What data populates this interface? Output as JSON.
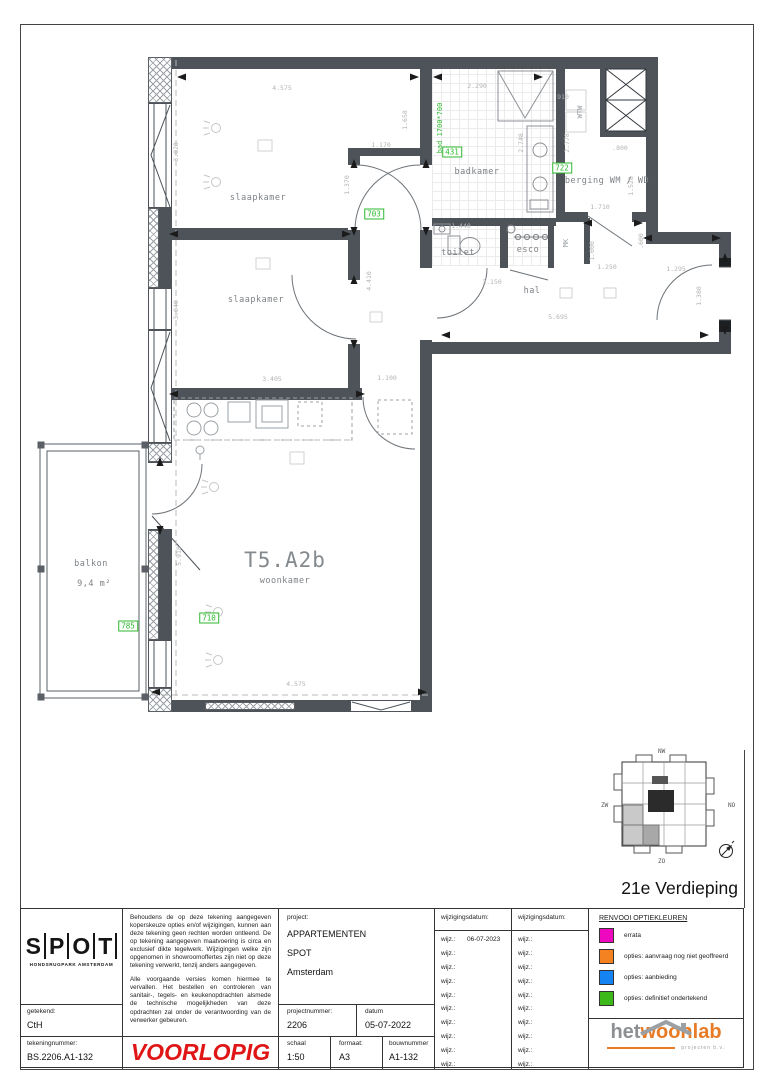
{
  "page": {
    "floor_title": "21e Verdieping"
  },
  "plan": {
    "unit_code": "T5.A2b",
    "unit_room": "woonkamer",
    "room_labels": [
      {
        "label": "slaapkamer",
        "x": 258,
        "y": 198
      },
      {
        "label": "slaapkamer",
        "x": 256,
        "y": 300
      },
      {
        "label": "badkamer",
        "x": 477,
        "y": 172
      },
      {
        "label": "berging WM / WD",
        "x": 607,
        "y": 181
      },
      {
        "label": "toilet",
        "x": 458,
        "y": 253
      },
      {
        "label": "esco",
        "x": 528,
        "y": 250
      },
      {
        "label": "hal",
        "x": 532,
        "y": 291
      },
      {
        "label": "balkon",
        "x": 91,
        "y": 564
      },
      {
        "label": "9,4  m²",
        "x": 94,
        "y": 584
      }
    ],
    "vertical_texts": [
      {
        "label": "bad 1700*700",
        "x": 440,
        "y": 128,
        "green": true
      },
      {
        "label": "WTW",
        "x": 580,
        "y": 112
      },
      {
        "label": "MK",
        "x": 566,
        "y": 243
      }
    ],
    "option_labels": [
      {
        "label": "431",
        "x": 452,
        "y": 152
      },
      {
        "label": "722",
        "x": 562,
        "y": 168
      },
      {
        "label": "703",
        "x": 374,
        "y": 214
      },
      {
        "label": "710",
        "x": 209,
        "y": 618
      },
      {
        "label": "785",
        "x": 128,
        "y": 626
      }
    ],
    "dimensions": [
      {
        "t": "4.575",
        "x": 282,
        "y": 88
      },
      {
        "t": "3.028",
        "x": 176,
        "y": 152,
        "r": 1
      },
      {
        "t": "1.170",
        "x": 381,
        "y": 145
      },
      {
        "t": "1.370",
        "x": 347,
        "y": 185,
        "r": 1
      },
      {
        "t": "1.658",
        "x": 405,
        "y": 120,
        "r": 1
      },
      {
        "t": "2.290",
        "x": 477,
        "y": 86
      },
      {
        "t": "2.748",
        "x": 521,
        "y": 143,
        "r": 1
      },
      {
        "t": "910",
        "x": 563,
        "y": 97
      },
      {
        "t": "2.778",
        "x": 567,
        "y": 143,
        "r": 1
      },
      {
        "t": ".800",
        "x": 620,
        "y": 148
      },
      {
        "t": "1.528",
        "x": 631,
        "y": 186,
        "r": 1
      },
      {
        "t": "1.710",
        "x": 600,
        "y": 207
      },
      {
        "t": "1.440",
        "x": 461,
        "y": 226
      },
      {
        "t": "3.150",
        "x": 492,
        "y": 282
      },
      {
        "t": "1.000",
        "x": 592,
        "y": 251,
        "r": 1
      },
      {
        "t": ".600",
        "x": 641,
        "y": 241,
        "r": 1
      },
      {
        "t": "1.250",
        "x": 607,
        "y": 267
      },
      {
        "t": "1.295",
        "x": 676,
        "y": 269
      },
      {
        "t": "1.380",
        "x": 699,
        "y": 296,
        "r": 1
      },
      {
        "t": "5.695",
        "x": 558,
        "y": 317
      },
      {
        "t": "3.405",
        "x": 272,
        "y": 379
      },
      {
        "t": "3.040",
        "x": 176,
        "y": 310,
        "r": 1
      },
      {
        "t": "4.410",
        "x": 369,
        "y": 281,
        "r": 1
      },
      {
        "t": "1.100",
        "x": 387,
        "y": 378
      },
      {
        "t": "4.575",
        "x": 296,
        "y": 684
      },
      {
        "t": "5.918",
        "x": 179,
        "y": 556,
        "r": 1
      }
    ]
  },
  "keyplan": {
    "north_west": "NW",
    "south_west": "ZW",
    "north_east": "NO",
    "south_east": "ZO"
  },
  "titleblock": {
    "logo_letters": [
      "S",
      "P",
      "O",
      "T"
    ],
    "logo_sub": "HONDSRUGPARK AMSTERDAM",
    "getekend_label": "getekend:",
    "getekend_value": "CtH",
    "tekeningnummer_label": "tekeningnummer:",
    "tekeningnummer_value": "BS.2206.A1-132",
    "disclaimer_p1": "Behoudens de op deze tekening aangegeven koperskeuze opties en/of wijzigingen, kunnen aan deze tekening geen rechten worden ontleend. De op tekening aangegeven maatvoering is circa en exclusief dikte tegelwerk. Wijzigingen welke zijn opgenomen in showroomoffertes zijn niet op deze tekening verwerkt, tenzij anders aangegeven.",
    "disclaimer_p2": "Alle voorgaande versies komen hiermee te vervallen. Het bestellen en controleren van sanitair-, tegels- en keukenopdrachten alsmede de technische mogelijkheden van deze opdrachten zal onder de verantwoording van de verwerker gebeuren.",
    "stamp": "VOORLOPIG",
    "project_label": "project:",
    "project_name": "APPARTEMENTEN",
    "project_sub": "SPOT",
    "project_city": "Amsterdam",
    "projectnummer_label": "projectnummer:",
    "projectnummer_value": "2206",
    "datum_label": "datum",
    "datum_value": "05-07-2022",
    "schaal_label": "schaal",
    "schaal_value": "1:50",
    "formaat_label": "formaat:",
    "formaat_value": "A3",
    "bouwnummer_label": "bouwnummer",
    "bouwnummer_value": "A1-132",
    "wijzigingsdatum_label": "wijzigingsdatum:",
    "wijz_label": "wijz.:",
    "wijz_col1": [
      "06-07-2023",
      "",
      "",
      "",
      "",
      "",
      "",
      "",
      "",
      ""
    ],
    "wijz_col2": [
      "",
      "",
      "",
      "",
      "",
      "",
      "",
      "",
      "",
      ""
    ],
    "legend_title": "RENVOOI OPTIEKLEUREN",
    "legend_items": [
      {
        "color": "#ee08c0",
        "label": "errata"
      },
      {
        "color": "#f58220",
        "label": "opties: aanvraag nog niet geoffreerd"
      },
      {
        "color": "#1584f2",
        "label": "opties: aanbieding"
      },
      {
        "color": "#3cb918",
        "label": "opties: definitief ondertekend"
      }
    ],
    "brand_het": "het",
    "brand_woonlab": "woonlab",
    "brand_sub": "projecten b.v."
  }
}
